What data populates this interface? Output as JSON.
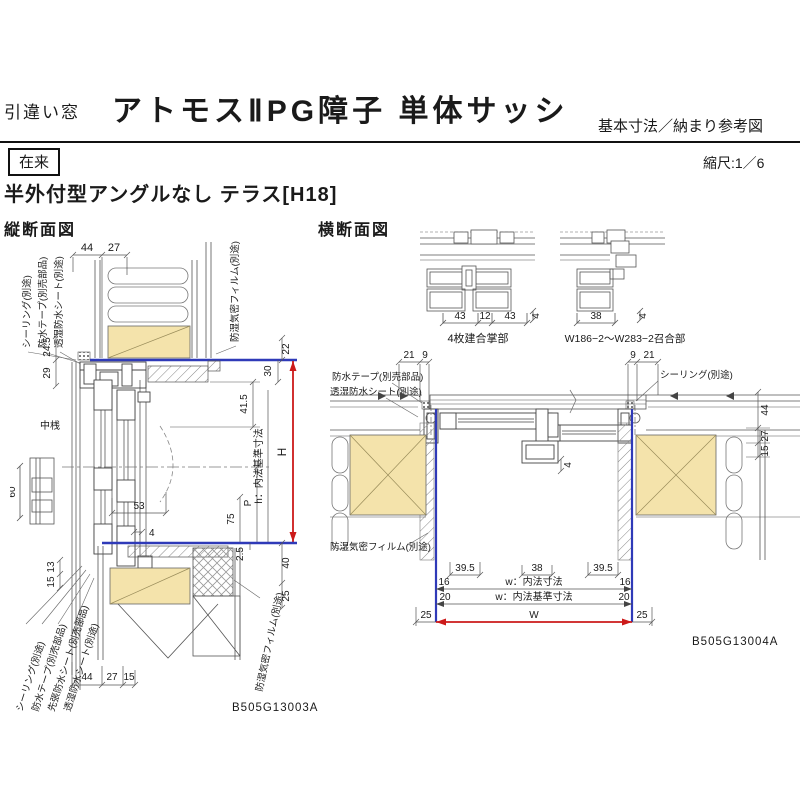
{
  "header": {
    "window_type": "引違い窓",
    "title": "アトモスⅡPG障子 単体サッシ",
    "subtitle": "基本寸法／納まり参考図",
    "badge": "在来",
    "scale": "縮尺:1／6",
    "section_title": "半外付型アングルなし テラス[H18]"
  },
  "vs": {
    "title": "縦断面図",
    "code": "B505G13003A",
    "ann": {
      "tl1": "シーリング(別途)",
      "tl2": "防水テープ(別売部品)",
      "tl3": "透湿防水シート(別途)",
      "tr": "防湿気密フィルム(別途)",
      "nakazan": "中桟",
      "bl1": "シーリング(別途)",
      "bl2": "防水テープ(別売部品)",
      "bl3": "先張防水シート(別売部品)",
      "bl4": "透湿防水シート(別途)",
      "br": "防湿気密フィルム(別途)"
    },
    "dim": {
      "t44": "44",
      "t27": "27",
      "l245": "24.5",
      "l29": "29",
      "l60": "60",
      "l13": "13",
      "l15": "15",
      "r22": "22",
      "r30": "30",
      "r415": "41.5",
      "rH": "H",
      "rh": "h：内法基準寸法",
      "rP": "P",
      "r75": "75",
      "r25": "2.5",
      "r40": "40",
      "r25b": "25",
      "m53": "53",
      "m4": "4",
      "b44": "44",
      "b27": "27",
      "b15": "15"
    }
  },
  "hs": {
    "title": "横断面図",
    "code": "B505G13004A",
    "d1": {
      "label": "4枚建合掌部",
      "a": "43",
      "b": "12",
      "c": "43",
      "d": "4"
    },
    "d2": {
      "label": "W186−2〜W283−2召合部",
      "a": "38",
      "b": "4"
    },
    "ann": {
      "l1": "防水テープ(別売部品)",
      "l2": "透湿防水シート(別途)",
      "r1": "シーリング(別途)",
      "bl": "防湿気密フィルム(別途)"
    },
    "dim": {
      "tl21": "21",
      "tl9": "9",
      "tr9": "9",
      "tr21": "21",
      "r44": "44",
      "r27": "27",
      "r15": "15",
      "c4": "4",
      "b395a": "39.5",
      "b38": "38",
      "b395b": "39.5",
      "b16a": "16",
      "bw1": "w：内法寸法",
      "b16b": "16",
      "b20a": "20",
      "bw2": "w：内法基準寸法",
      "b20b": "20",
      "b25a": "25",
      "bW": "W",
      "b25b": "25"
    }
  },
  "colors": {
    "wood": "#f4e3ab",
    "blue": "#2f3ab8",
    "red": "#cc1a1a"
  }
}
